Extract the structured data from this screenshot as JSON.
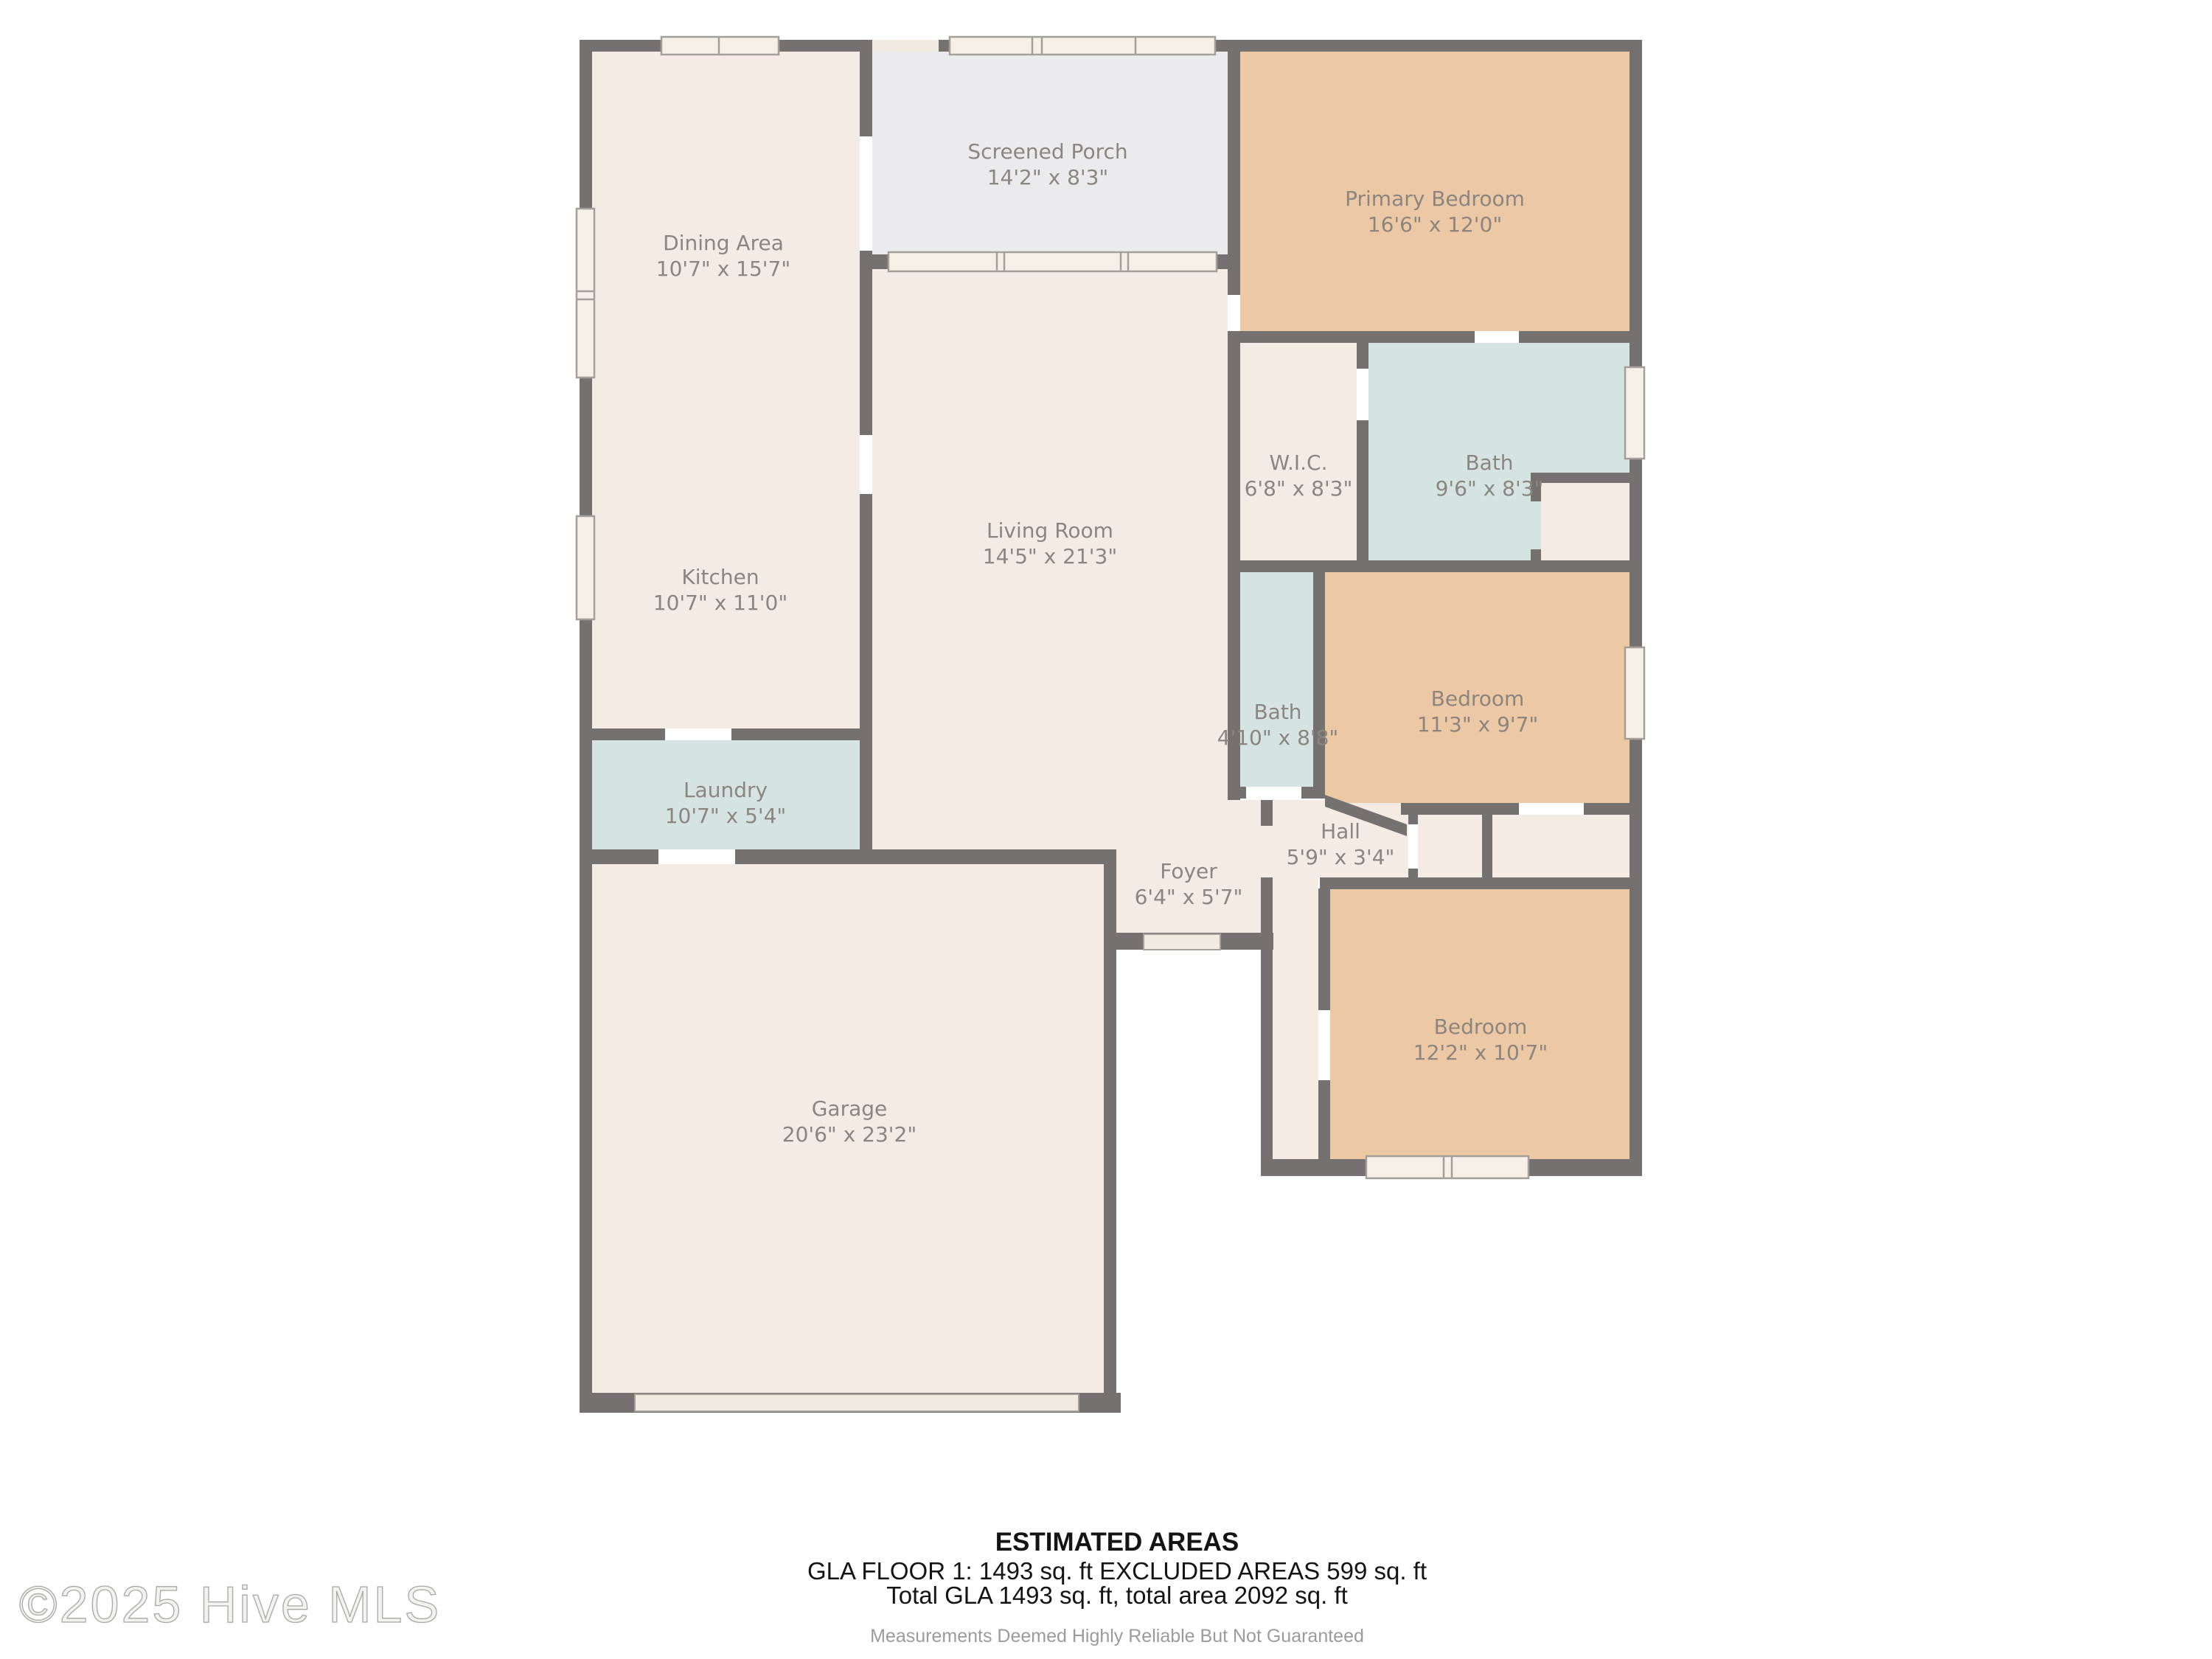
{
  "rooms": [
    {
      "id": "dining-area",
      "name": "Dining Area",
      "dims": "10'7\" x 15'7\""
    },
    {
      "id": "screened-porch",
      "name": "Screened Porch",
      "dims": "14'2\" x 8'3\""
    },
    {
      "id": "primary-bedroom",
      "name": "Primary Bedroom",
      "dims": "16'6\" x 12'0\""
    },
    {
      "id": "kitchen",
      "name": "Kitchen",
      "dims": "10'7\" x 11'0\""
    },
    {
      "id": "living-room",
      "name": "Living Room",
      "dims": "14'5\" x 21'3\""
    },
    {
      "id": "wic",
      "name": "W.I.C.",
      "dims": "6'8\" x 8'3\""
    },
    {
      "id": "primary-bath",
      "name": "Bath",
      "dims": "9'6\" x 8'3\""
    },
    {
      "id": "hall-bath",
      "name": "Bath",
      "dims": "4'10\" x 8'8\""
    },
    {
      "id": "middle-bedroom",
      "name": "Bedroom",
      "dims": "11'3\" x 9'7\""
    },
    {
      "id": "laundry",
      "name": "Laundry",
      "dims": "10'7\" x 5'4\""
    },
    {
      "id": "foyer",
      "name": "Foyer",
      "dims": "6'4\" x 5'7\""
    },
    {
      "id": "hall",
      "name": "Hall",
      "dims": "5'9\" x 3'4\""
    },
    {
      "id": "garage",
      "name": "Garage",
      "dims": "20'6\" x 23'2\""
    },
    {
      "id": "bottom-bedroom",
      "name": "Bedroom",
      "dims": "12'2\" x 10'7\""
    }
  ],
  "footer": {
    "title": "ESTIMATED AREAS",
    "line1": "GLA FLOOR 1: 1493 sq. ft EXCLUDED AREAS 599 sq. ft",
    "line2": "Total GLA 1493 sq. ft, total area 2092 sq. ft",
    "disclaimer": "Measurements Deemed Highly Reliable But Not Guaranteed"
  },
  "watermark": "©2025 Hive MLS",
  "colors": {
    "wall": "#767171",
    "floor": "#f4ebe4",
    "porch": "#ebebed",
    "bedroom": "#ecc9a4",
    "wet": "#d6e3e3",
    "window_fill": "#f6f0e9",
    "door_fill": "#f2ebe2",
    "window_line": "#a59f99",
    "label_text": "#8b8681"
  }
}
